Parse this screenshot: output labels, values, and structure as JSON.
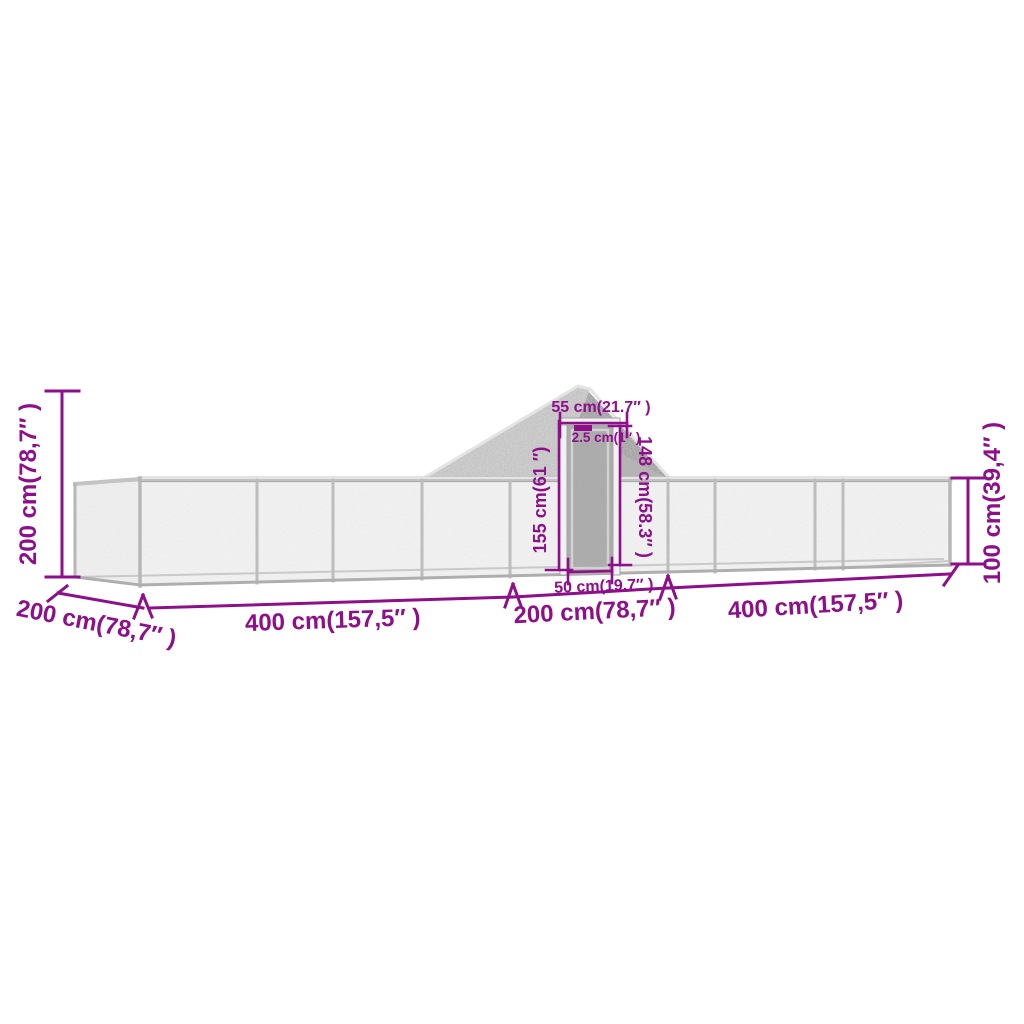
{
  "diagram": {
    "title": "chicken-coop-run-dimension-diagram",
    "accent_color": "#8E0F8A",
    "dims": {
      "left_height": "200 cm(78,7″ )",
      "depth": "200 cm(78,7″ )",
      "run_left": "400 cm(157,5″ )",
      "mid_section": "200 cm(78,7″ )",
      "run_right": "400 cm(157,5″ )",
      "right_height": "100 cm(39,4″ )",
      "door_frame_width": "55 cm(21.7″ )",
      "tube_thickness": "2.5 cm(1″ )",
      "door_height_outer": "155 cm(61 ″)",
      "door_height_inner": "148 cm(58.3″ )",
      "door_width": "50 cm(19.7″ )"
    }
  }
}
